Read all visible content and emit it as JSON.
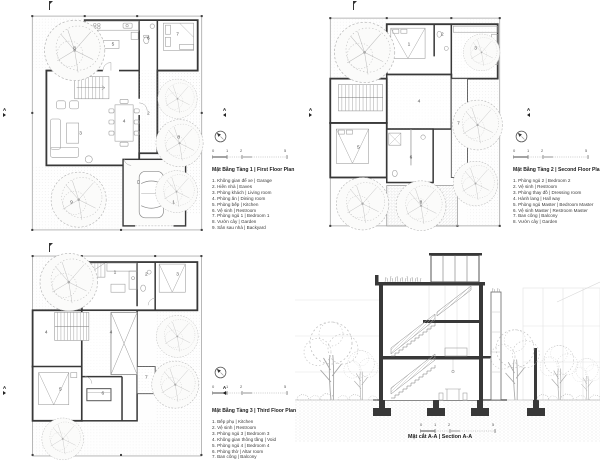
{
  "colors": {
    "wall_ink": "#383838",
    "furniture_line": "#9a9a9a",
    "tree_line": "#b8b8b8",
    "text_ink": "#1c1c1c",
    "paper": "#ffffff"
  },
  "scalebar": {
    "labels": [
      "0",
      "1",
      "2",
      "5"
    ]
  },
  "marker": {
    "label": "A"
  },
  "plans": [
    {
      "key": "plan1",
      "title": "Mặt Bằng Tầng 1  |  First Floor Plan",
      "legend": [
        "1. Không gian để xe  |  Garage",
        "2. Hiên nhà  |  Eaves",
        "3. Phòng khách  |  Living room",
        "4. Phòng ăn  |  Dining room",
        "5. Phòng bếp  |  Kitchen",
        "6. Vệ sinh  |  Restroom",
        "7. Phòng ngủ 1  |  Bedroom 1",
        "8. Vườn cây  |  Garden",
        "9. Sân sau nhà  |  Backyard"
      ],
      "rooms": [
        {
          "n": "8",
          "x": "26.7%",
          "y": "19.1%"
        },
        {
          "n": "5",
          "x": "47.8%",
          "y": "17.4%"
        },
        {
          "n": "6",
          "x": "67.2%",
          "y": "14.8%"
        },
        {
          "n": "7",
          "x": "83.3%",
          "y": "13.0%"
        },
        {
          "n": "3",
          "x": "30.0%",
          "y": "55.7%"
        },
        {
          "n": "4",
          "x": "53.9%",
          "y": "50.4%"
        },
        {
          "n": "2",
          "x": "67.2%",
          "y": "47.0%"
        },
        {
          "n": "8",
          "x": "83.9%",
          "y": "57.4%"
        },
        {
          "n": "9",
          "x": "25.0%",
          "y": "85.2%"
        },
        {
          "n": "1",
          "x": "81.1%",
          "y": "85.2%"
        }
      ]
    },
    {
      "key": "plan2",
      "title": "Mặt Bằng Tầng 2  |  Second Floor Plan",
      "legend": [
        "1. Phòng ngủ 2  |  Bedroom 2",
        "2. Vệ sinh  |  Restroom",
        "3. Phòng thay đồ  |  Dressing room",
        "4. Hành lang  |  Hall way",
        "5. Phòng ngủ Master  |  Bedroom Master",
        "6. Vệ sinh Master  |  Restroom Master",
        "7. Ban công  |  Balcony",
        "8. Vườn cây  |  Garden"
      ],
      "rooms": [
        {
          "n": "1",
          "x": "46.7%",
          "y": "17.4%"
        },
        {
          "n": "2",
          "x": "65.0%",
          "y": "13.0%"
        },
        {
          "n": "3",
          "x": "83.3%",
          "y": "19.1%"
        },
        {
          "n": "4",
          "x": "52.2%",
          "y": "41.7%"
        },
        {
          "n": "5",
          "x": "18.9%",
          "y": "61.7%"
        },
        {
          "n": "6",
          "x": "47.8%",
          "y": "66.1%"
        },
        {
          "n": "7",
          "x": "73.9%",
          "y": "51.3%"
        },
        {
          "n": "8",
          "x": "53.3%",
          "y": "85.2%"
        }
      ]
    },
    {
      "key": "plan3",
      "title": "Mặt Bằng Tầng 3  |  Third Floor Plan",
      "legend": [
        "1. Bếp phụ  |  Kitchen",
        "2. Vệ sinh  |  Restroom",
        "3. Phòng ngủ 3  |  Bedroom 3",
        "4. Không gian thông tầng  |  Void",
        "5. Phòng ngủ 4  |  Bedroom 4",
        "6. Phòng thờ  |  Altar room",
        "7. Ban công  |  Balcony"
      ],
      "rooms": [
        {
          "n": "1",
          "x": "48.9%",
          "y": "12.1%"
        },
        {
          "n": "2",
          "x": "66.1%",
          "y": "13.0%"
        },
        {
          "n": "3",
          "x": "83.3%",
          "y": "13.0%"
        },
        {
          "n": "4",
          "x": "11.1%",
          "y": "40.0%"
        },
        {
          "n": "4",
          "x": "46.7%",
          "y": "40.0%"
        },
        {
          "n": "5",
          "x": "18.9%",
          "y": "66.0%"
        },
        {
          "n": "6",
          "x": "42.2%",
          "y": "67.9%"
        },
        {
          "n": "7",
          "x": "66.1%",
          "y": "60.5%"
        }
      ]
    }
  ],
  "section": {
    "title": "Mặt cắt A-A  |  Section A-A"
  }
}
